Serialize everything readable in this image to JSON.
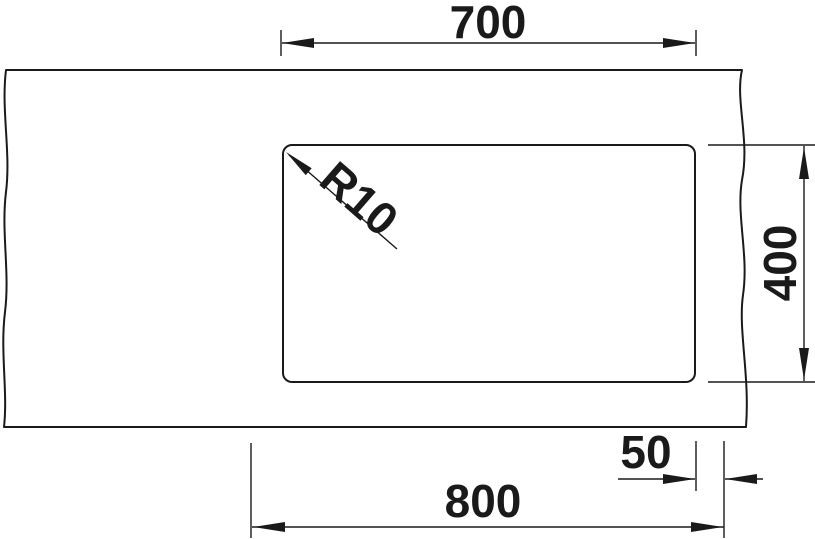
{
  "drawing": {
    "background_color": "#ffffff",
    "line_color": "#1a1a1a",
    "dimensions": {
      "basin_width": "700",
      "basin_depth": "400",
      "edge_distance": "50",
      "cabinet_width": "800",
      "corner_radius": "R10"
    }
  }
}
